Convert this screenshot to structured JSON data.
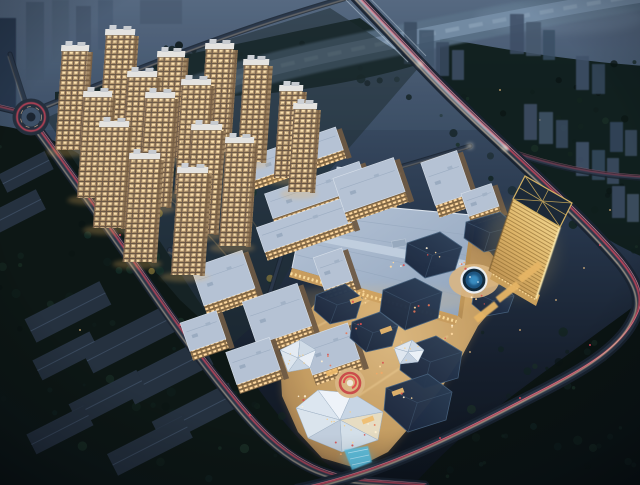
{
  "meta": {
    "description": "Dusk aerial architectural rendering of a mixed-use development: a cluster of warmly lit residential high-rise towers, a large flat-roofed shopping mall, an open-air commercial street with angular dark-roofed pavilions and faceted crystal skylight roofs, a circular fountain plaza, a red event plaza, and a golden diagrid office tower, surrounded by dark tree masses, a river with a bridge, and roads streaked with red and white light trails."
  },
  "palette": {
    "sky_top": "#4e6078",
    "sky_mid": "#33445a",
    "ground_dark": "#10161f",
    "water": "#6d849c",
    "tree_dark": "#0e1b1a",
    "road_bed": "#1a2431",
    "road_core": "#2c3a4c",
    "trail_red": "#e8485f",
    "trail_pink": "#ff93a6",
    "trail_white": "#ffe2b8",
    "tower_warm": "#c9ac84",
    "window_bright": "#ffe6b4",
    "roof_light": "#b5c2d4",
    "mall_roof": "#a9b9cd",
    "facade_gold": "#d9b272",
    "pavilion_navy": "#22324a",
    "crystal_white": "#e2eaf2",
    "gold_tower": "#ecc873",
    "fountain_blue": "#1d5480",
    "plaza_warm": "#d9b684",
    "accent_red": "#c84848",
    "canopy_blue": "#56c6ee",
    "haze_blue": "#46586e"
  },
  "scene": {
    "elements": [
      {
        "name": "residential-towers",
        "desc": "sixteen warm-lit high-rise apartment towers, upper left"
      },
      {
        "name": "shopping-mall",
        "desc": "large pale blue flat roof, center"
      },
      {
        "name": "midrise-office-blocks",
        "desc": "low blocks with gold lit facades and light roofs around the mall"
      },
      {
        "name": "commercial-street",
        "desc": "warm lit pedestrian street with dark hexagonal pavilion roofs, bottom center"
      },
      {
        "name": "crystal-roofs",
        "desc": "white faceted skylight roofs on the street"
      },
      {
        "name": "event-plaza",
        "desc": "red circular plaza feature"
      },
      {
        "name": "fountain-plaza",
        "desc": "round blue fountain east of the mall"
      },
      {
        "name": "gold-office-tower",
        "desc": "golden diagrid tower, right"
      },
      {
        "name": "blue-canopy",
        "desc": "glowing blue entrance canopy at the street south end"
      },
      {
        "name": "river",
        "desc": "hazy river crossing the top"
      },
      {
        "name": "bridge-road",
        "desc": "bright arterial road crossing the river"
      },
      {
        "name": "ring-road",
        "desc": "curving roads with red and white light trails around the site"
      },
      {
        "name": "roundabout",
        "desc": "small roundabout with red trails, upper left"
      },
      {
        "name": "warehouse-district",
        "desc": "dark gabled slab buildings among trees, lower left"
      },
      {
        "name": "background-city",
        "desc": "faint blue-grey building clusters in haze"
      }
    ]
  }
}
